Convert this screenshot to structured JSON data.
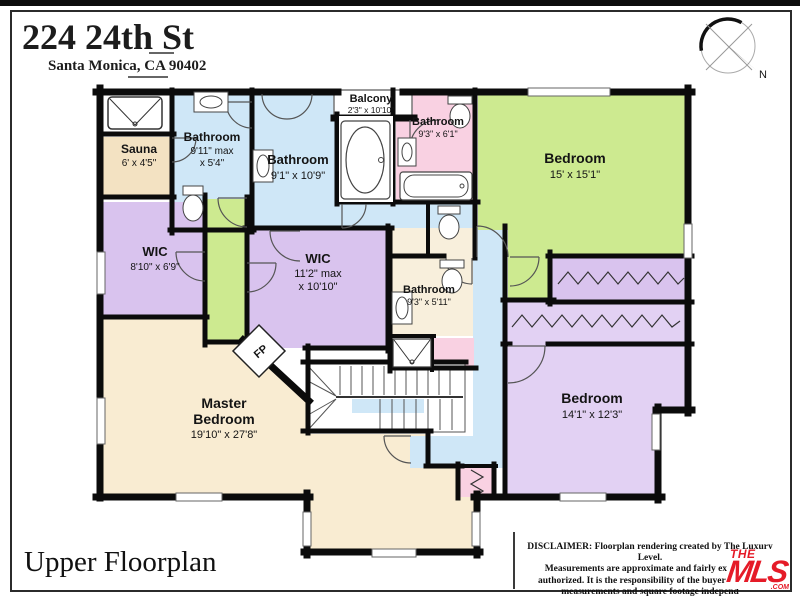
{
  "header": {
    "address": "224 24th St",
    "city": "Santa Monica, CA 90402"
  },
  "compass": {
    "north": "N"
  },
  "rooms": {
    "bath_top_left": {
      "name": "Bathroom",
      "dim1": "9'11\" max",
      "dim2": "x 5'4\""
    },
    "sauna": {
      "name": "Sauna",
      "dim1": "6' x 4'5\""
    },
    "bath_middle": {
      "name": "Bathroom",
      "dim1": "9'1\" x 10'9\""
    },
    "balcony": {
      "name": "Balcony",
      "dim1": "2'3\" x 10'10\""
    },
    "bath_pink": {
      "name": "Bathroom",
      "dim1": "9'3\" x 6'1\""
    },
    "bedroom_green": {
      "name": "Bedroom",
      "dim1": "15' x 15'1\""
    },
    "wic_left": {
      "name": "WIC",
      "dim1": "8'10\" x 6'9\""
    },
    "wic_center": {
      "name": "WIC",
      "dim1": "11'2\" max",
      "dim2": "x 10'10\""
    },
    "bath_lower": {
      "name": "Bathroom",
      "dim1": "9'3\" x 5'11\""
    },
    "master": {
      "name1": "Master",
      "name2": "Bedroom",
      "dim1": "19'10\" x 27'8\""
    },
    "bedroom_purple": {
      "name": "Bedroom",
      "dim1": "14'1\" x 12'3\""
    },
    "fireplace": {
      "label": "FP"
    }
  },
  "footer": {
    "title": "Upper Floorplan",
    "disclaimer_line1": "DISCLAIMER: Floorplan rendering created by The Luxury Level.",
    "disclaimer_line2": "Measurements are approximate and fairly exact but",
    "disclaimer_line3": "authorized. It is the responsibility of the buyer to verify",
    "disclaimer_line4": "measurements and square footage independ",
    "logo": {
      "the": "THE",
      "mls": "MLS",
      "com": ".COM"
    }
  },
  "colors": {
    "wall": "#0b0b0b",
    "blue_room": "#cfe7f7",
    "green_room": "#cdea90",
    "purple_wic": "#d9c3ee",
    "purple_bedroom": "#e2d1f3",
    "pink_room": "#f9d1e2",
    "tan_master": "#f9ecd2",
    "tan_sauna": "#f3e2c2",
    "cream_bath": "#f8efdc",
    "mls_red": "#e51b28"
  }
}
